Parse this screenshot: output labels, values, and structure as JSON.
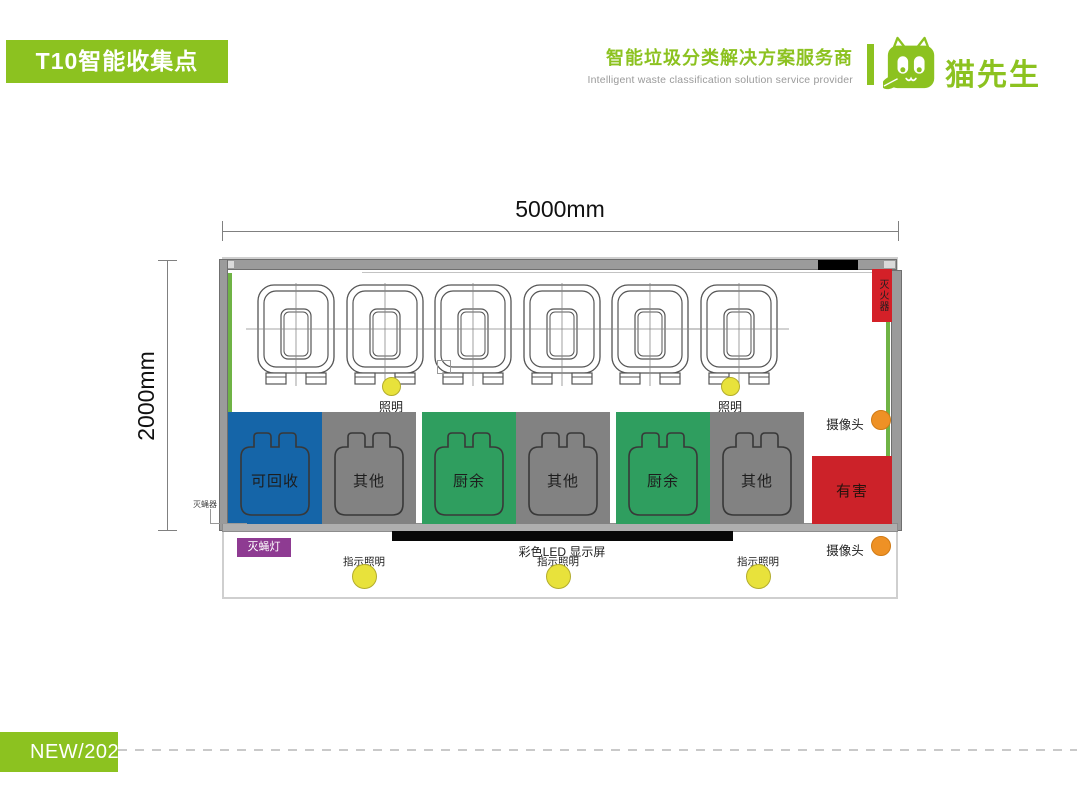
{
  "header": {
    "title_badge": "T10智能收集点",
    "tagline_zh": "智能垃圾分类解决方案服务商",
    "tagline_en": "Intelligent waste classification solution service provider",
    "brand_name": "猫先生"
  },
  "plan": {
    "width_label": "5000mm",
    "height_label": "2000mm",
    "fire_extinguisher_label": "灭火器",
    "camera_top_label": "摄像头",
    "camera_bottom_label": "摄像头",
    "ceiling_light_1_label": "照明",
    "ceiling_light_2_label": "照明",
    "fly_killer_device_label": "灭蝇器",
    "fly_lamp_label": "灭蝇灯",
    "led_display_label": "彩色LED 显示屏",
    "indicator_light_1_label": "指示照明",
    "indicator_light_2_label": "指示照明",
    "indicator_light_3_label": "指示照明",
    "bins": [
      {
        "label": "可回收",
        "color": "#1565A8"
      },
      {
        "label": "其他",
        "color": "#828282"
      },
      {
        "label": "厨余",
        "color": "#2F9E5F"
      },
      {
        "label": "其他",
        "color": "#828282"
      },
      {
        "label": "厨余",
        "color": "#2F9E5F"
      },
      {
        "label": "其他",
        "color": "#828282"
      },
      {
        "label": "有害",
        "color": "#CC2229"
      }
    ],
    "colors": {
      "brand_green": "#8CC220",
      "wall_gray": "#9B9B9B",
      "wall_green_strip": "#6FB345",
      "light_yellow": "#E8E23B",
      "camera_orange": "#EE9125",
      "fire_red": "#D42028",
      "lamp_purple": "#8E3B92",
      "led_black": "#070707"
    }
  },
  "footer": {
    "badge": "NEW/2022"
  }
}
